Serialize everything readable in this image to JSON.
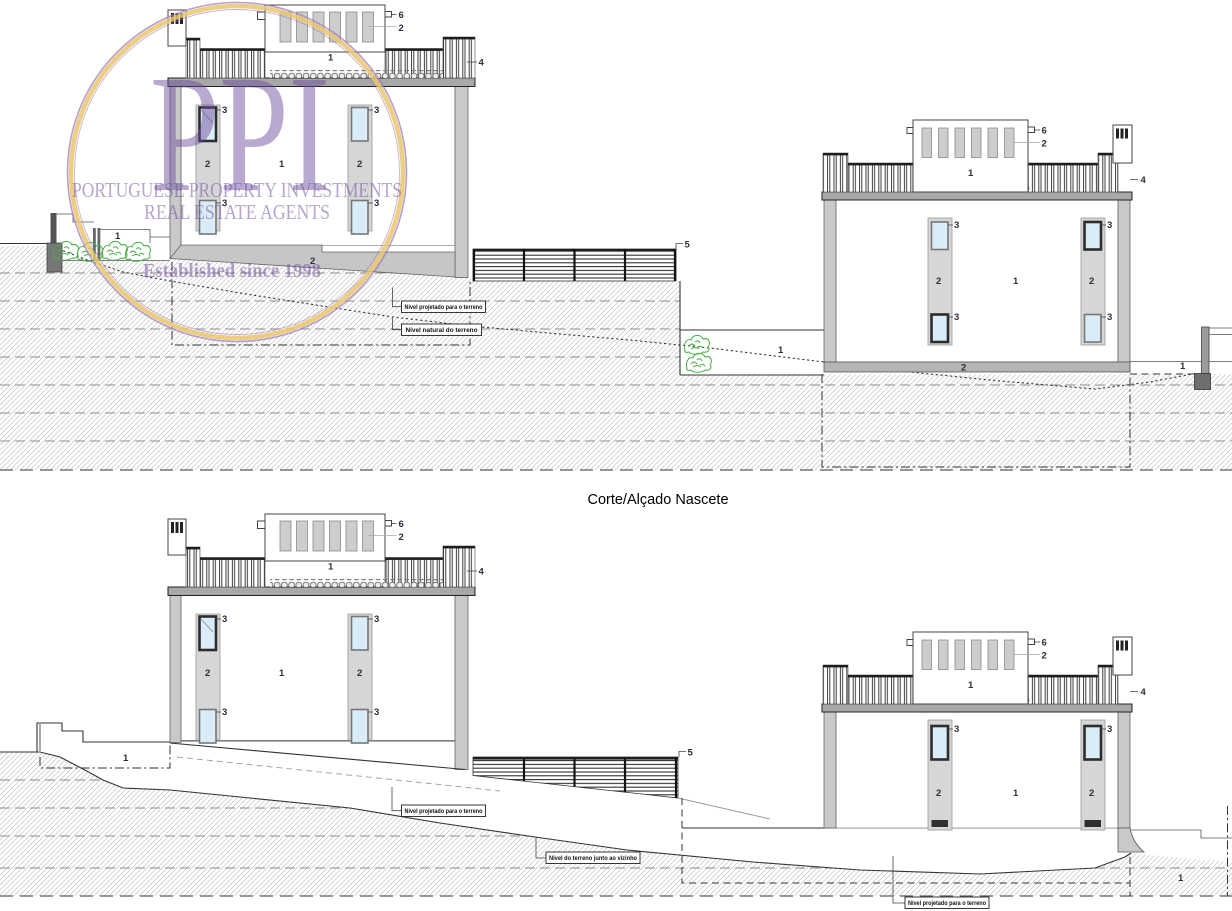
{
  "title": "Corte/Alçado Nascete",
  "watermark": {
    "initials": "PPI",
    "line1": "PORTUGUESE PROPERTY INVESTMENTS",
    "line2": "REAL ESTATE AGENTS",
    "line3": "Established since 1998"
  },
  "callouts": {
    "roof_terrace": "1",
    "slat": "2",
    "window": "3",
    "guardrail": "4",
    "boundary_fence": "5",
    "roof_marker": "6",
    "pilaster": "2",
    "facade": "1",
    "base": "2",
    "ground": "1"
  },
  "annotations": {
    "level_projected": "Nível projetado para o terreno",
    "level_natural": "Nível natural do terreno",
    "level_neighbor": "Nível do terreno junto ao vizinho"
  },
  "colors": {
    "watermark_purple": "#6d4a9c",
    "watermark_gold": "#e9c56f",
    "wall_gray": "#c9c9c9",
    "pilaster_gray": "#d6d6d6",
    "glass_blue": "#d9ecf7",
    "hatch_gray": "#c2c2c2",
    "vegetation_green": "#43b043",
    "line_dark": "#333333"
  }
}
